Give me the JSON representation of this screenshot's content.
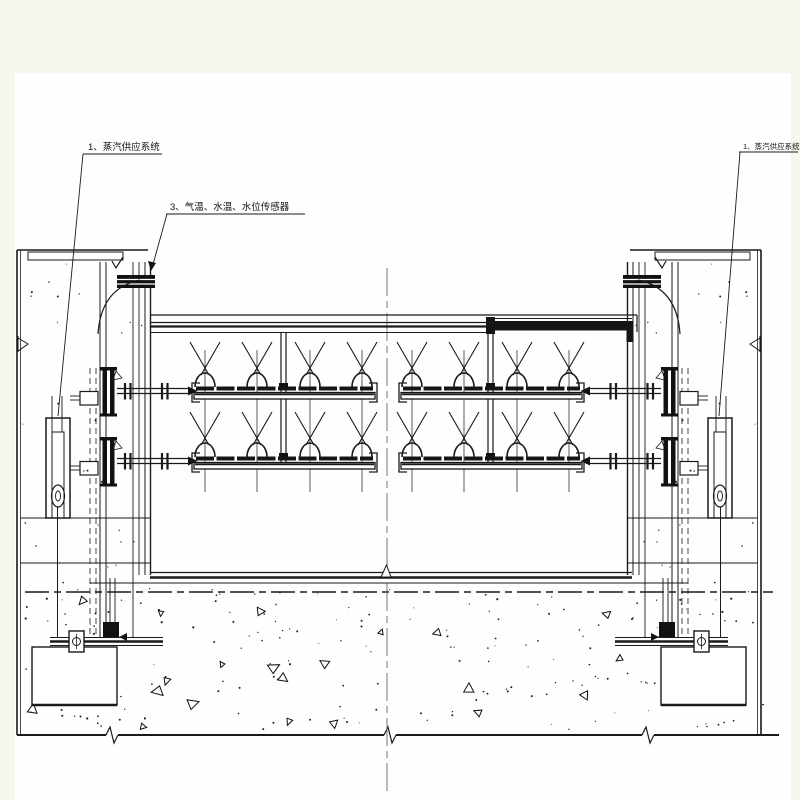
{
  "drawing": {
    "labels": {
      "steam_left": "1、蒸汽供应系统",
      "sensors": "3、气温、水温、水位传感器",
      "steam_right": "1、蒸汽供应系统"
    },
    "colors": {
      "background": "#f3f7ec",
      "sheet": "#fefefe",
      "line": "#1a1a1a"
    }
  }
}
